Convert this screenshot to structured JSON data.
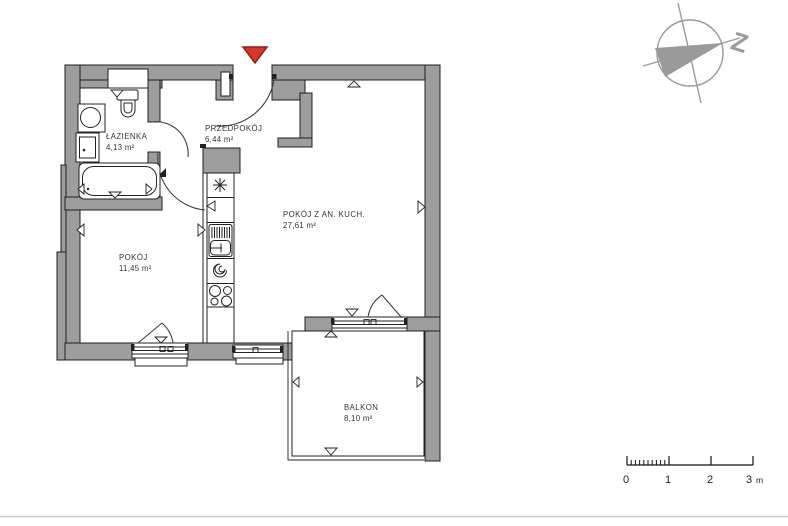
{
  "plan": {
    "rooms": [
      {
        "id": "lazienka",
        "name": "ŁAZIENKA",
        "area": "4,13 m²"
      },
      {
        "id": "przedpokoj",
        "name": "PRZEDPOKÓJ",
        "area": "6,44 m²"
      },
      {
        "id": "pokoj-z-aneksem",
        "name": "POKÓJ Z AN. KUCH.",
        "area": "27,61 m²"
      },
      {
        "id": "pokoj",
        "name": "POKÓJ",
        "area": "11,45 m²"
      },
      {
        "id": "balkon",
        "name": "BALKON",
        "area": "8,10 m²"
      }
    ],
    "colors": {
      "wall": "#9d9d9d",
      "outline": "#1f1f1f",
      "entrance_marker": "#d2392c",
      "entrance_marker_border": "#8f1d16",
      "compass": "#9a9a9a"
    }
  },
  "compass": {
    "label": "Z"
  },
  "scale_bar": {
    "tick_labels": [
      "0",
      "1",
      "2",
      "3"
    ],
    "unit": "m"
  }
}
